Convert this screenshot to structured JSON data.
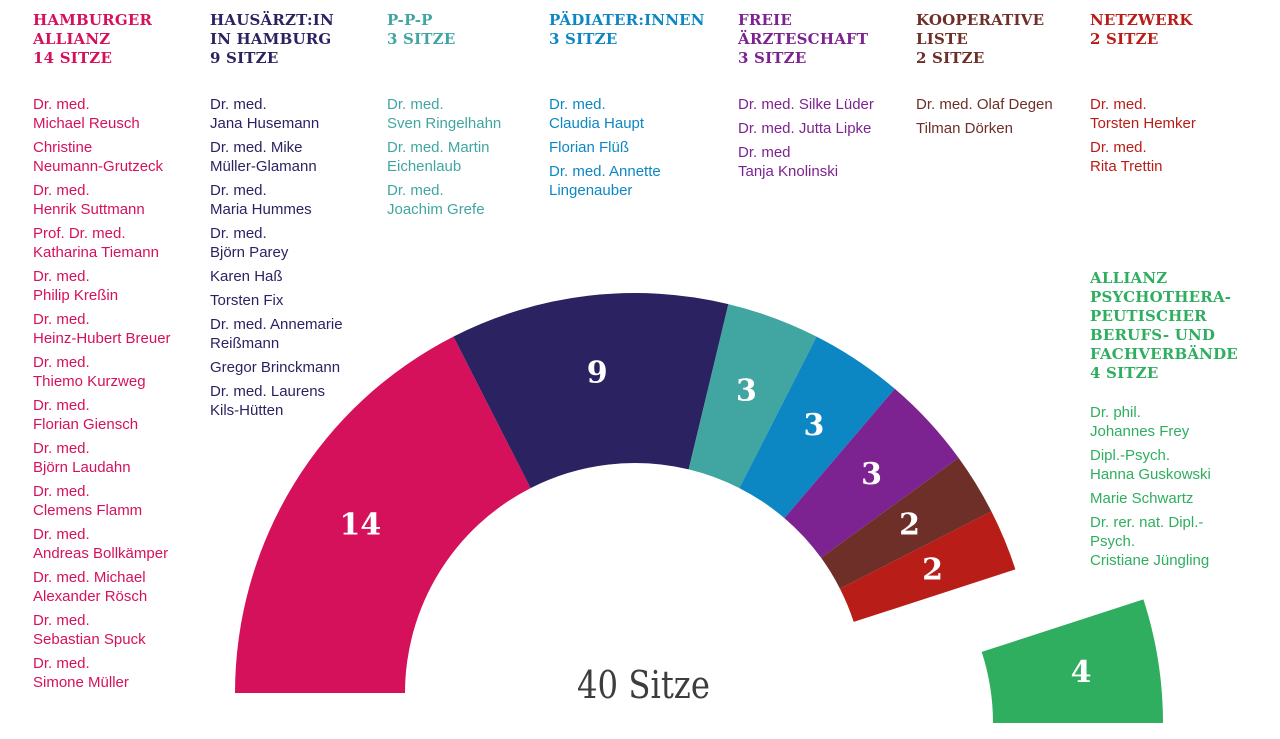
{
  "center_label": "40 Sitze",
  "parties": [
    {
      "name": "HAMBURGER ALLIANZ",
      "header": "HAMBURGER\nALLIANZ\n14 SITZE",
      "seats": 14,
      "color": "#d6115c",
      "members": [
        "Dr. med.\nMichael Reusch",
        "Christine\nNeumann-Grutzeck",
        "Dr. med.\nHenrik Suttmann",
        "Prof. Dr. med.\nKatharina Tiemann",
        "Dr. med.\nPhilip Kreßin",
        "Dr. med.\nHeinz-Hubert Breuer",
        "Dr. med.\nThiemo Kurzweg",
        "Dr. med.\nFlorian Giensch",
        "Dr. med.\nBjörn Laudahn",
        "Dr. med.\nClemens Flamm",
        "Dr. med.\nAndreas Bollkämper",
        "Dr. med. Michael\nAlexander Rösch",
        "Dr. med.\nSebastian Spuck",
        "Dr. med.\nSimone Müller"
      ]
    },
    {
      "name": "HAUSÄRZT:IN IN HAMBURG",
      "header": "HAUSÄRZT:IN\nIN HAMBURG\n9 SITZE",
      "seats": 9,
      "color": "#2b2361",
      "members": [
        "Dr. med.\nJana Husemann",
        "Dr. med. Mike\nMüller-Glamann",
        "Dr. med.\nMaria Hummes",
        "Dr. med.\nBjörn Parey",
        "Karen Haß",
        "Torsten Fix",
        "Dr. med. Annemarie\nReißmann",
        "Gregor Brinckmann",
        "Dr. med. Laurens\nKils-Hütten"
      ]
    },
    {
      "name": "P-P-P",
      "header": "P-P-P\n3 SITZE",
      "seats": 3,
      "color": "#41a6a1",
      "members": [
        "Dr. med.\nSven Ringelhahn",
        "Dr. med. Martin\nEichenlaub",
        "Dr. med.\nJoachim Grefe"
      ]
    },
    {
      "name": "PÄDIATER:INNEN",
      "header": "PÄDIATER:INNEN\n3 SITZE",
      "seats": 3,
      "color": "#0c87c4",
      "members": [
        "Dr. med.\nClaudia Haupt",
        "Florian Flüß",
        "Dr. med. Annette\nLingenauber"
      ]
    },
    {
      "name": "FREIE ÄRZTESCHAFT",
      "header": "FREIE\nÄRZTESCHAFT\n3 SITZE",
      "seats": 3,
      "color": "#7d2391",
      "members": [
        "Dr. med. Silke Lüder",
        "Dr. med. Jutta Lipke",
        "Dr. med\nTanja Knolinski"
      ]
    },
    {
      "name": "KOOPERATIVE LISTE",
      "header": "KOOPERATIVE\nLISTE\n2 SITZE",
      "seats": 2,
      "color": "#6e2f28",
      "members": [
        "Dr. med. Olaf Degen",
        "Tilman Dörken"
      ]
    },
    {
      "name": "NETZWERK",
      "header": "NETZWERK\n2 SITZE",
      "seats": 2,
      "color": "#b81d18",
      "members": [
        "Dr. med.\nTorsten Hemker",
        "Dr. med.\nRita Trettin"
      ]
    },
    {
      "name": "ALLIANZ PSYCHOTHERAPEUTISCHER BERUFS- UND FACHVERBÄNDE",
      "header": "ALLIANZ\nPSYCHOTHERA-\nPEUTISCHER\nBERUFS- UND\nFACHVERBÄNDE\n4 SITZE",
      "seats": 4,
      "color": "#2fae60",
      "members": [
        "Dr. phil.\nJohannes Frey",
        "Dipl.-Psych.\nHanna Guskowski",
        "Marie Schwartz",
        "Dr. rer. nat. Dipl.-\nPsych.\nCristiane Jüngling"
      ]
    }
  ],
  "chart_data": {
    "type": "pie",
    "variant": "hemicycle-half-donut",
    "title": "40 Sitze",
    "total_seats": 40,
    "categories": [
      "HAMBURGER ALLIANZ",
      "HAUSÄRZT:IN IN HAMBURG",
      "P-P-P",
      "PÄDIATER:INNEN",
      "FREIE ÄRZTESCHAFT",
      "KOOPERATIVE LISTE",
      "NETZWERK",
      "ALLIANZ PSYCHOTHERAPEUTISCHER BERUFS- UND FACHVERBÄNDE"
    ],
    "values": [
      14,
      9,
      3,
      3,
      3,
      2,
      2,
      4
    ],
    "segment_labels": [
      "14",
      "9",
      "3",
      "3",
      "3",
      "2",
      "2",
      "4"
    ],
    "colors": [
      "#d6115c",
      "#2b2361",
      "#41a6a1",
      "#0c87c4",
      "#7d2391",
      "#6e2f28",
      "#b81d18",
      "#2fae60"
    ],
    "start_angle_deg": 180,
    "end_angle_deg": 0,
    "exploded_index": 7,
    "legend_position": "top-columns",
    "grid": false
  }
}
